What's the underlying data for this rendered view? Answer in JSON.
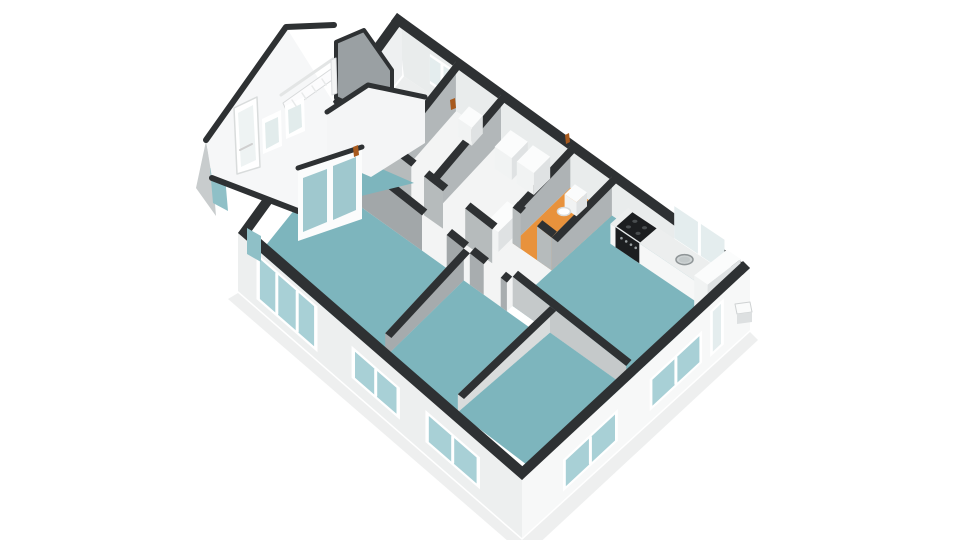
{
  "app": {
    "kind": "floor-plan-3d-render",
    "background": "#ffffff"
  },
  "palette": {
    "bg": "#ffffff",
    "wallTop": "#2e3133",
    "floorTeal": "#7db5bd",
    "floorOrange": "#e8923c",
    "floorWhite": "#f3f4f4",
    "floorGray": "#eceeee",
    "neInner": "#e9ecec",
    "nwInner": "#eef0f1",
    "extSE": "#f7f8f8",
    "extSW": "#edefef",
    "extNW": "#c8cccd",
    "glassTeal": "#a8d0d6",
    "glassLight": "#e4edee",
    "frame": "#ffffff",
    "counterTop": "#eceeee",
    "counterFront": "#f6f7f7",
    "counterSide": "#d9dcdd",
    "stove": "#1c1e20",
    "burner": "#4a4e50",
    "steel": "#ced3d4",
    "steelRim": "#8f9597",
    "boxTop": "#fbfcfc",
    "boxFront": "#f1f3f3",
    "boxSide": "#dfe2e3",
    "doorAccent": "#a85a1e",
    "shadow": "#5a5e60"
  },
  "scene": {
    "floor_quad": {
      "n": [
        400,
        68
      ],
      "e": [
        748,
        300
      ],
      "s": [
        527,
        470
      ],
      "w": [
        249,
        258
      ]
    },
    "outer_quad": {
      "n": [
        397,
        13
      ],
      "e": [
        750,
        268
      ],
      "s": [
        522,
        480
      ],
      "w": [
        238,
        233
      ]
    },
    "wall_height": {
      "base": 60,
      "slope": 0.105,
      "min": 12
    },
    "rooms": [
      {
        "name": "storage-room-1",
        "u1": 0.02,
        "v1": 0.02,
        "u2": 0.17,
        "v2": 0.44,
        "fill": "floorGray"
      },
      {
        "name": "storage-room-2",
        "u1": 0.17,
        "v1": 0.02,
        "u2": 0.3,
        "v2": 0.44,
        "fill": "floorWhite"
      },
      {
        "name": "bathroom",
        "u1": 0.3,
        "v1": 0.02,
        "u2": 0.5,
        "v2": 0.44,
        "fill": "floorWhite"
      },
      {
        "name": "toilet-room",
        "u1": 0.5,
        "v1": 0.02,
        "u2": 0.62,
        "v2": 0.33,
        "fill": "floorOrange"
      },
      {
        "name": "toilet-hall",
        "u1": 0.5,
        "v1": 0.33,
        "u2": 0.62,
        "v2": 0.56,
        "fill": "floorWhite"
      },
      {
        "name": "kitchen",
        "u1": 0.62,
        "v1": 0.02,
        "u2": 0.985,
        "v2": 0.53,
        "fill": "floorTeal"
      },
      {
        "name": "hallway",
        "u1": 0.02,
        "v1": 0.44,
        "u2": 0.5,
        "v2": 0.56,
        "fill": "floorWhite"
      },
      {
        "name": "living-room",
        "u1": 0.015,
        "v1": 0.56,
        "u2": 0.48,
        "v2": 0.985,
        "fill": "floorTeal"
      },
      {
        "name": "bedroom-1",
        "u1": 0.48,
        "v1": 0.56,
        "u2": 0.74,
        "v2": 0.985,
        "fill": "floorTeal"
      },
      {
        "name": "bedroom-2",
        "u1": 0.74,
        "v1": 0.53,
        "u2": 0.985,
        "v2": 0.985,
        "fill": "floorTeal"
      }
    ],
    "walls_far": [
      {
        "name": "wall-storage-divider",
        "dir": "v",
        "u1": 0.17,
        "v1": 0.02,
        "u2": 0.17,
        "v2": 0.44,
        "fill": "#b2b7b9"
      },
      {
        "name": "wall-storage-bathroom",
        "dir": "v",
        "u1": 0.3,
        "v1": 0.02,
        "u2": 0.3,
        "v2": 0.44,
        "fill": "#b2b7b9"
      },
      {
        "name": "wall-bathroom-toilet",
        "dir": "v",
        "u1": 0.5,
        "v1": 0.02,
        "u2": 0.5,
        "v2": 0.33,
        "fill": "#aeb3b5"
      },
      {
        "name": "wall-toilet-kitchen",
        "dir": "v",
        "u1": 0.62,
        "v1": 0.02,
        "u2": 0.62,
        "v2": 0.33,
        "fill": "#aeb3b5"
      }
    ],
    "walls_near": [
      {
        "name": "wall-toilet-front-a",
        "dir": "u",
        "u1": 0.5,
        "v1": 0.33,
        "u2": 0.525,
        "v2": 0.33,
        "fill": "#b6bbbc"
      },
      {
        "name": "wall-toilet-front-b",
        "dir": "u",
        "u1": 0.575,
        "v1": 0.33,
        "u2": 0.62,
        "v2": 0.33,
        "fill": "#b6bbbc"
      },
      {
        "name": "wall-hall-a",
        "dir": "u",
        "u1": 0.02,
        "v1": 0.44,
        "u2": 0.1,
        "v2": 0.44,
        "fill": "#b6bbbc"
      },
      {
        "name": "wall-hall-b",
        "dir": "u",
        "u1": 0.135,
        "v1": 0.44,
        "u2": 0.245,
        "v2": 0.44,
        "fill": "#b6bbbc"
      },
      {
        "name": "wall-hall-c",
        "dir": "u",
        "u1": 0.285,
        "v1": 0.44,
        "u2": 0.345,
        "v2": 0.44,
        "fill": "#b6bbbc"
      },
      {
        "name": "wall-hall-d",
        "dir": "u",
        "u1": 0.415,
        "v1": 0.44,
        "u2": 0.5,
        "v2": 0.44,
        "fill": "#b6bbbc"
      },
      {
        "name": "wall-kitchen-bedroom2",
        "dir": "u",
        "u1": 0.62,
        "v1": 0.53,
        "u2": 0.985,
        "v2": 0.53,
        "fill": "#c5c9ca"
      },
      {
        "name": "wall-living-hall-a",
        "dir": "u",
        "u1": 0.02,
        "v1": 0.56,
        "u2": 0.345,
        "v2": 0.56,
        "fill": "#a2a7a9"
      },
      {
        "name": "wall-living-hall-b",
        "dir": "u",
        "u1": 0.425,
        "v1": 0.56,
        "u2": 0.48,
        "v2": 0.56,
        "fill": "#a2a7a9"
      },
      {
        "name": "wall-bedroom1-hall-a",
        "dir": "u",
        "u1": 0.5,
        "v1": 0.56,
        "u2": 0.545,
        "v2": 0.56,
        "fill": "#a8adaf"
      },
      {
        "name": "wall-bedroom1-hall-b",
        "dir": "u",
        "u1": 0.6,
        "v1": 0.56,
        "u2": 0.62,
        "v2": 0.56,
        "fill": "#a8adaf"
      },
      {
        "name": "wall-living-bedroom1",
        "dir": "v",
        "u1": 0.48,
        "v1": 0.56,
        "u2": 0.48,
        "v2": 0.985,
        "fill": "#a6abad"
      },
      {
        "name": "wall-bedroom-divider",
        "dir": "v",
        "u1": 0.74,
        "v1": 0.53,
        "u2": 0.74,
        "v2": 0.985,
        "fill": "#d9dcdc"
      }
    ],
    "boxes": [
      {
        "name": "utility-sink",
        "u1": 0.215,
        "v1": 0.035,
        "u2": 0.255,
        "v2": 0.1,
        "h": 18
      },
      {
        "name": "washbasin-1",
        "u1": 0.335,
        "v1": 0.035,
        "u2": 0.385,
        "v2": 0.125,
        "h": 22
      },
      {
        "name": "washbasin-2",
        "u1": 0.4,
        "v1": 0.035,
        "u2": 0.45,
        "v2": 0.125,
        "h": 22
      },
      {
        "name": "washing-machine",
        "u1": 0.45,
        "v1": 0.27,
        "u2": 0.49,
        "v2": 0.39,
        "h": 20
      },
      {
        "name": "toilet",
        "u1": 0.527,
        "v1": 0.045,
        "u2": 0.562,
        "v2": 0.1,
        "h": 14,
        "bowl": true
      },
      {
        "name": "kitchen-counter",
        "u1": 0.67,
        "v1": 0.025,
        "u2": 0.955,
        "v2": 0.115,
        "h": 20,
        "counter": true
      },
      {
        "name": "fridge-cabinet",
        "u1": 0.955,
        "v1": 0.025,
        "u2": 0.995,
        "v2": 0.175,
        "h": 44
      }
    ],
    "stove": {
      "u1": 0.685,
      "v1": 0.03,
      "u2": 0.755,
      "v2": 0.11,
      "h": 20
    },
    "sink": {
      "u": 0.86,
      "v": 0.07,
      "h": 20,
      "rx": 8.5,
      "ry": 5
    },
    "ne_windows": [
      {
        "name": "ne-window-storage",
        "u1": 0.095,
        "u2": 0.165,
        "dy1": 10,
        "dy2": 40,
        "glass": "glassLight"
      },
      {
        "name": "kitchen-window",
        "u1": 0.8,
        "u2": 0.945,
        "dy1": 16,
        "dy2": 54,
        "glass": "glassLight"
      }
    ],
    "ext_windows": [
      {
        "name": "se-back-door",
        "edge": "se",
        "t1": 0.115,
        "t2": 0.175,
        "dy1": 6,
        "dy2": 52,
        "panes": 1,
        "glass": "glassLight"
      },
      {
        "name": "se-window-1",
        "edge": "se",
        "t1": 0.21,
        "t2": 0.44,
        "dy1": 18,
        "dy2": 50,
        "panes": 2,
        "glass": "glassTeal"
      },
      {
        "name": "se-window-2",
        "edge": "se",
        "t1": 0.58,
        "t2": 0.82,
        "dy1": 18,
        "dy2": 50,
        "panes": 2,
        "glass": "glassTeal"
      },
      {
        "name": "sw-window-1",
        "edge": "sw",
        "t1": 0.148,
        "t2": 0.34,
        "dy1": 14,
        "dy2": 46,
        "panes": 2,
        "glass": "glassTeal"
      },
      {
        "name": "sw-window-2",
        "edge": "sw",
        "t1": 0.43,
        "t2": 0.6,
        "dy1": 14,
        "dy2": 46,
        "panes": 2,
        "glass": "glassTeal"
      },
      {
        "name": "sw-window-3",
        "edge": "sw",
        "t1": 0.72,
        "t2": 0.935,
        "dy1": 4,
        "dy2": 50,
        "panes": 3,
        "glass": "glassTeal"
      }
    ],
    "traced": [
      {
        "name": "annex-floor",
        "pts": [
          [
            226,
            170
          ],
          [
            306,
            136
          ],
          [
            414,
            183
          ],
          [
            296,
            212
          ]
        ],
        "fill": "#7db5bd"
      },
      {
        "name": "annex-inner-gable",
        "pts": [
          [
            336,
            42
          ],
          [
            336,
            98
          ],
          [
            392,
            124
          ],
          [
            392,
            70
          ],
          [
            364,
            30
          ]
        ],
        "fill": "#9aa0a3",
        "stroke": "#2e3133",
        "sw": 4
      },
      {
        "name": "annex-outer-wall",
        "pts": [
          [
            206,
            141
          ],
          [
            213,
            179
          ],
          [
            216,
            216
          ],
          [
            196,
            188
          ]
        ],
        "fill": "#c8cccd"
      },
      {
        "name": "annex-outer-window",
        "pts": [
          [
            210,
            168
          ],
          [
            213,
            203
          ],
          [
            228,
            211
          ],
          [
            225,
            176
          ]
        ],
        "fill": "#8fc0c7"
      },
      {
        "name": "annex-gable-wall",
        "pts": [
          [
            286,
            27
          ],
          [
            206,
            140
          ],
          [
            212,
            178
          ],
          [
            298,
            211
          ],
          [
            352,
            132
          ]
        ],
        "fill": "#f6f7f8"
      },
      {
        "name": "annex-roof-edge",
        "pts": [
          [
            206,
            140
          ],
          [
            286,
            27
          ],
          [
            334,
            25
          ]
        ],
        "fill": "none",
        "stroke": "#2e3133",
        "sw": 6
      },
      {
        "name": "annex-base-edge",
        "pts": [
          [
            212,
            178
          ],
          [
            298,
            211
          ]
        ],
        "fill": "none",
        "stroke": "#2e3133",
        "sw": 6
      },
      {
        "name": "annex-stair-rail",
        "pts": [
          [
            281,
            95
          ],
          [
            333,
            59
          ]
        ],
        "fill": "none",
        "stroke": "#e3e5e5",
        "sw": 3
      },
      {
        "name": "annex-stairs",
        "pts": [
          [
            283,
            103
          ],
          [
            331,
            69
          ],
          [
            335,
            78
          ],
          [
            287,
            112
          ]
        ],
        "fill": "#fcfcfd",
        "stroke": "#d8dadb",
        "sw": 1
      },
      {
        "name": "annex-stair-post",
        "pts": [
          [
            331,
            60
          ],
          [
            336,
            58
          ],
          [
            337,
            93
          ],
          [
            332,
            95
          ]
        ],
        "fill": "#f4f5f5",
        "stroke": "#dcdee0",
        "sw": 1
      },
      {
        "name": "annex-door",
        "pts": [
          [
            234,
            108
          ],
          [
            257,
            97
          ],
          [
            260,
            167
          ],
          [
            237,
            174
          ]
        ],
        "fill": "#ffffff",
        "stroke": "#d9dcdc",
        "sw": 1.5
      },
      {
        "name": "annex-door-glass",
        "pts": [
          [
            238,
            113
          ],
          [
            253,
            105
          ],
          [
            256,
            160
          ],
          [
            241,
            167
          ]
        ],
        "fill": "#eef3f3"
      },
      {
        "name": "annex-door-handle",
        "pts": [
          [
            240,
            150
          ],
          [
            252,
            144
          ]
        ],
        "fill": "none",
        "stroke": "#cfcfcf",
        "sw": 2
      },
      {
        "name": "annex-window-1",
        "pts": [
          [
            262,
            119
          ],
          [
            281,
            110
          ],
          [
            282,
            146
          ],
          [
            263,
            154
          ]
        ],
        "fill": "#ffffff"
      },
      {
        "name": "annex-window-1-glass",
        "pts": [
          [
            265,
            123
          ],
          [
            278,
            117
          ],
          [
            279,
            142
          ],
          [
            266,
            149
          ]
        ],
        "fill": "#e2ecec"
      },
      {
        "name": "annex-window-2",
        "pts": [
          [
            285,
            106
          ],
          [
            304,
            97
          ],
          [
            305,
            131
          ],
          [
            286,
            139
          ]
        ],
        "fill": "#ffffff"
      },
      {
        "name": "annex-window-2-glass",
        "pts": [
          [
            288,
            110
          ],
          [
            301,
            104
          ],
          [
            302,
            127
          ],
          [
            289,
            134
          ]
        ],
        "fill": "#e2ecec"
      },
      {
        "name": "junction-gable",
        "pts": [
          [
            368,
            85
          ],
          [
            327,
            112
          ],
          [
            327,
            158
          ],
          [
            371,
            177
          ],
          [
            425,
            143
          ],
          [
            425,
            97
          ]
        ],
        "fill": "#f4f5f6"
      },
      {
        "name": "junction-roof-edge",
        "pts": [
          [
            327,
            112
          ],
          [
            368,
            85
          ],
          [
            425,
            97
          ]
        ],
        "fill": "none",
        "stroke": "#2e3133",
        "sw": 5
      },
      {
        "name": "french-doors-frame",
        "pts": [
          [
            298,
            168
          ],
          [
            362,
            147
          ],
          [
            362,
            219
          ],
          [
            298,
            241
          ]
        ],
        "fill": "#fbfcfc"
      },
      {
        "name": "french-door-glass-1",
        "pts": [
          [
            303,
            178
          ],
          [
            327,
            169
          ],
          [
            327,
            222
          ],
          [
            303,
            232
          ]
        ],
        "fill": "#9fc8ce"
      },
      {
        "name": "french-door-glass-2",
        "pts": [
          [
            333,
            166
          ],
          [
            356,
            157
          ],
          [
            356,
            210
          ],
          [
            333,
            220
          ]
        ],
        "fill": "#9fc8ce"
      },
      {
        "name": "french-doors-top-edge",
        "pts": [
          [
            298,
            168
          ],
          [
            362,
            147
          ]
        ],
        "fill": "none",
        "stroke": "#2e3133",
        "sw": 5
      },
      {
        "name": "nw-door-glimpse",
        "pts": [
          [
            247,
            228
          ],
          [
            247,
            254
          ],
          [
            261,
            262
          ],
          [
            261,
            236
          ]
        ],
        "fill": "#8fc0c7"
      },
      {
        "name": "vent-box-top",
        "pts": [
          [
            735,
            304
          ],
          [
            750,
            302
          ],
          [
            752,
            312
          ],
          [
            737,
            314
          ]
        ],
        "fill": "#fafbfb",
        "stroke": "#cfd2d3",
        "sw": 1
      },
      {
        "name": "vent-box-front",
        "pts": [
          [
            737,
            314
          ],
          [
            752,
            312
          ],
          [
            752,
            322
          ],
          [
            737,
            324
          ]
        ],
        "fill": "#dde0e1"
      },
      {
        "name": "door-accent-storage",
        "pts": [
          [
            450,
            100
          ],
          [
            455,
            98
          ],
          [
            456,
            108
          ],
          [
            451,
            110
          ]
        ],
        "fill": "#a85a1e"
      },
      {
        "name": "door-accent-toilet",
        "pts": [
          [
            565,
            135
          ],
          [
            569,
            133
          ],
          [
            570,
            142
          ],
          [
            566,
            144
          ]
        ],
        "fill": "#a85a1e"
      },
      {
        "name": "door-accent-annex",
        "pts": [
          [
            353,
            147
          ],
          [
            358,
            145
          ],
          [
            359,
            155
          ],
          [
            354,
            157
          ]
        ],
        "fill": "#a85a1e"
      }
    ]
  }
}
